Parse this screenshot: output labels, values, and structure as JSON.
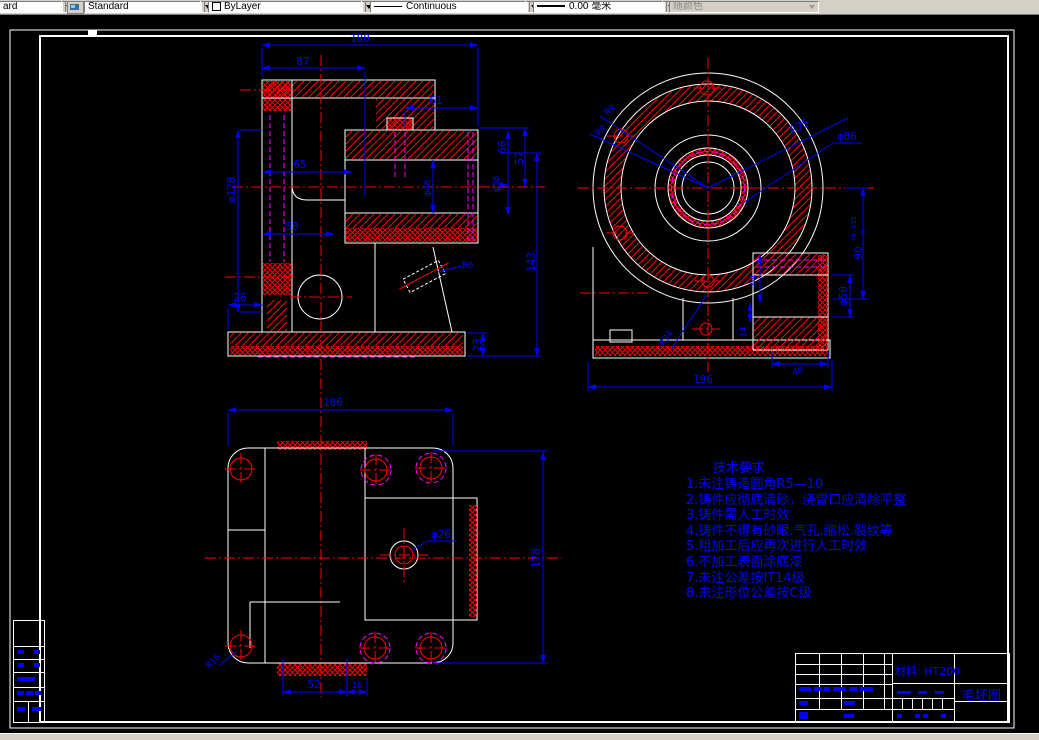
{
  "toolbar": {
    "style_partial": "ard",
    "text_style": "Standard",
    "color": "ByLayer",
    "linetype": "Continuous",
    "lineweight": "0.00 毫米",
    "plot_style": "随颜色"
  },
  "tech": {
    "title": "技术要求",
    "items": [
      "1.未注铸造圆角R5—10",
      "2.铸件应彻底清砂，浇冒口应清除平整",
      "3.铸件需人工时效",
      "4.铸件不得有砂眼.气孔.缩松.裂纹等",
      "5.粗加工后应再次进行人工时效",
      "6.不加工表面涂底漆",
      "7.未注公差按IT14级",
      "8.未注形位公差按C级"
    ]
  },
  "title_block": {
    "material": "材料: HT200",
    "drawing_name": "毛坯图"
  },
  "dims": {
    "front": {
      "w180": "180",
      "w87": "87",
      "w61": "61",
      "w65": "65",
      "w50": "50",
      "w26": "26",
      "h23": "23",
      "h143": "143",
      "h57": "57",
      "h66": "66",
      "phi128": "φ128",
      "phi48": "φ48",
      "phi58": "φ58",
      "r6": "R6"
    },
    "side": {
      "r75": "R75",
      "phi86": "φ86",
      "r9": "R9",
      "phi9": "φ9",
      "v90": "90",
      "v90up": "+0.035",
      "v90dn": "0",
      "phi50": "φ50",
      "w196": "196",
      "h64": "64",
      "h14": "14",
      "r34": "R34",
      "w40": "40"
    },
    "top": {
      "w186": "186",
      "h178": "178",
      "phi26": "φ26",
      "w52": "52",
      "w16": "16",
      "r16": "R16"
    }
  },
  "colors": {
    "background": "#000000",
    "outline": "#ffffff",
    "hatch": "#ff0000",
    "hidden": "#ff00ff",
    "dimension": "#0000ff",
    "toolbar": "#d4d0c8"
  }
}
